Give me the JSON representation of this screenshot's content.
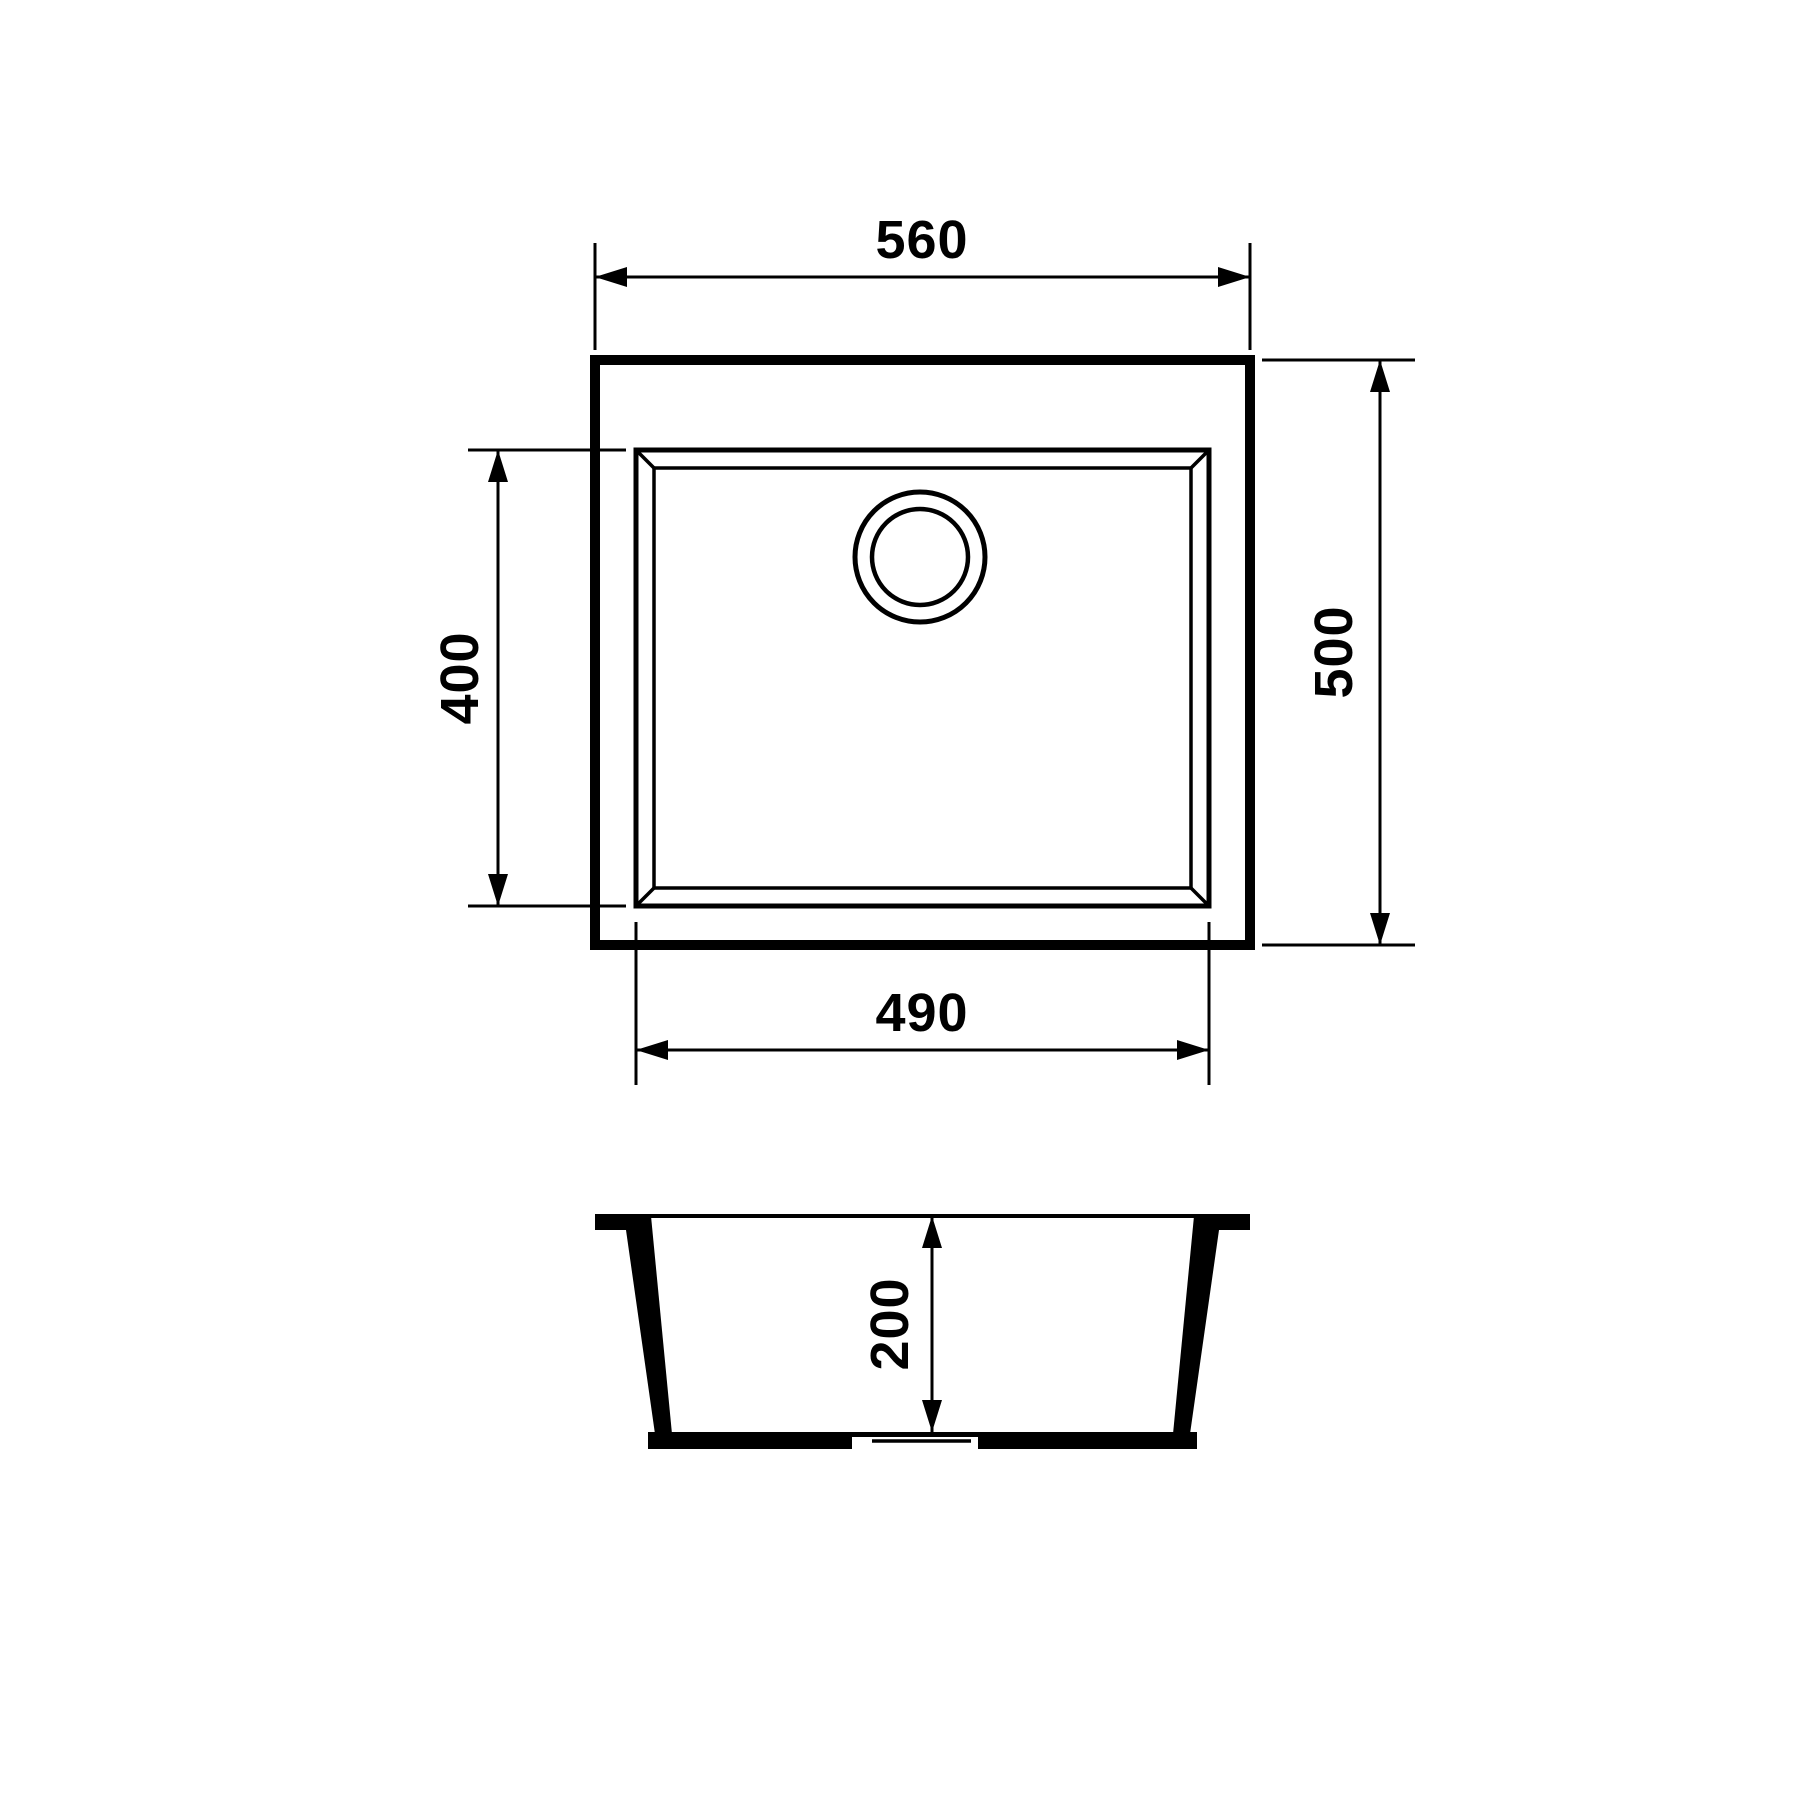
{
  "drawing": {
    "background": "#ffffff",
    "line_color": "#000000",
    "views": {
      "top_view": "sink-top-view",
      "section_view": "sink-front-section"
    },
    "dimensions": {
      "overall_width": "560",
      "overall_depth": "500",
      "bowl_depth": "400",
      "bowl_width": "490",
      "bowl_height": "200"
    }
  }
}
